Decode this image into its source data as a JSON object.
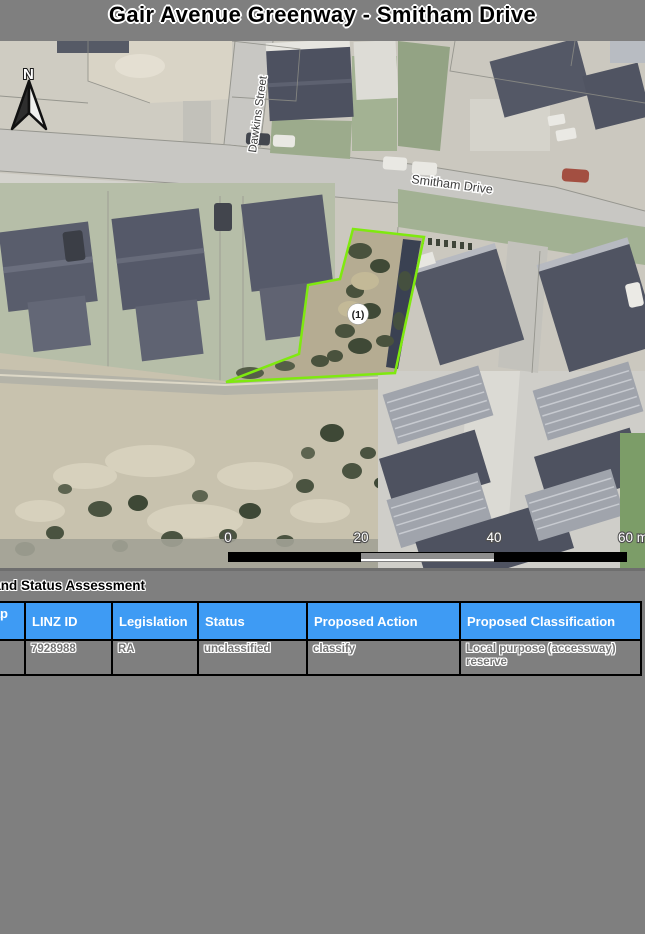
{
  "page": {
    "title": "Gair Avenue Greenway - Smitham Drive",
    "background_color": "#7f7f7f"
  },
  "map": {
    "north_label": "N",
    "street_labels": [
      "Dawkins Street",
      "Smitham Drive"
    ],
    "site_marker_label": "(1)",
    "site_outline_color": "#7fe90f",
    "scale_bar": {
      "ticks": [
        "0",
        "20",
        "40",
        "60 m"
      ]
    }
  },
  "assessment": {
    "heading": "Land Status Assessment",
    "header_color": "#3e9bf4",
    "table": {
      "headers": [
        "Map ID",
        "LINZ ID",
        "Legislation",
        "Status",
        "Proposed Action",
        "Proposed Classification"
      ],
      "rows": [
        {
          "map_id": "",
          "linz_id": "7928988",
          "legislation": "RA",
          "status": "unclassified",
          "proposed_action": "classify",
          "proposed_classification": "Local purpose (accessway) reserve"
        }
      ]
    }
  }
}
